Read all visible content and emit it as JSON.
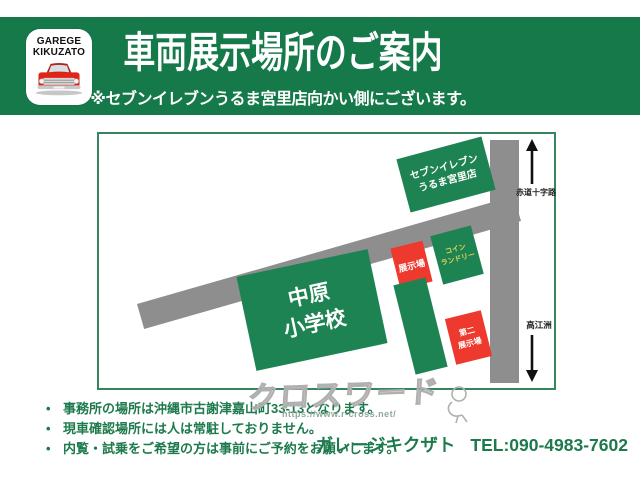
{
  "banner": {
    "logo_line1": "GAREGE",
    "logo_line2": "KIKUZATO",
    "title": "車両展示場所のご案内",
    "subtitle": "※セブンイレブンうるま宮里店向かい側にございます。"
  },
  "map": {
    "seven_eleven_label": "セブンイレブン\nうるま宮里店",
    "school_label": "中原\n小学校",
    "exhibit_label": "展示場",
    "second_exhibit_label": "第二\n展示場",
    "coin_laundry_label": "コイン\nランドリー",
    "north_road_label": "赤道十字路",
    "south_road_label": "高江洲"
  },
  "notes": {
    "items": [
      "事務所の場所は沖縄市古謝津嘉山町33-13となります。",
      "現車確認場所には人は常駐しておりません。",
      "内覧・試乗をご希望の方は事前にご予約をお願いします。"
    ]
  },
  "footer": {
    "shop_name": "ガレージキクザト",
    "tel": "TEL:090-4983-7602"
  },
  "watermark": {
    "text": "クロスワード",
    "url": "https://www.r-cross.net/"
  },
  "colors": {
    "banner_green": "#15794a",
    "block_green": "#1e8352",
    "block_red": "#ee3a2e",
    "road_gray": "#8e8e8e",
    "laundry_text_yellow": "#e8d354",
    "note_text_green": "#1d7a4c"
  }
}
